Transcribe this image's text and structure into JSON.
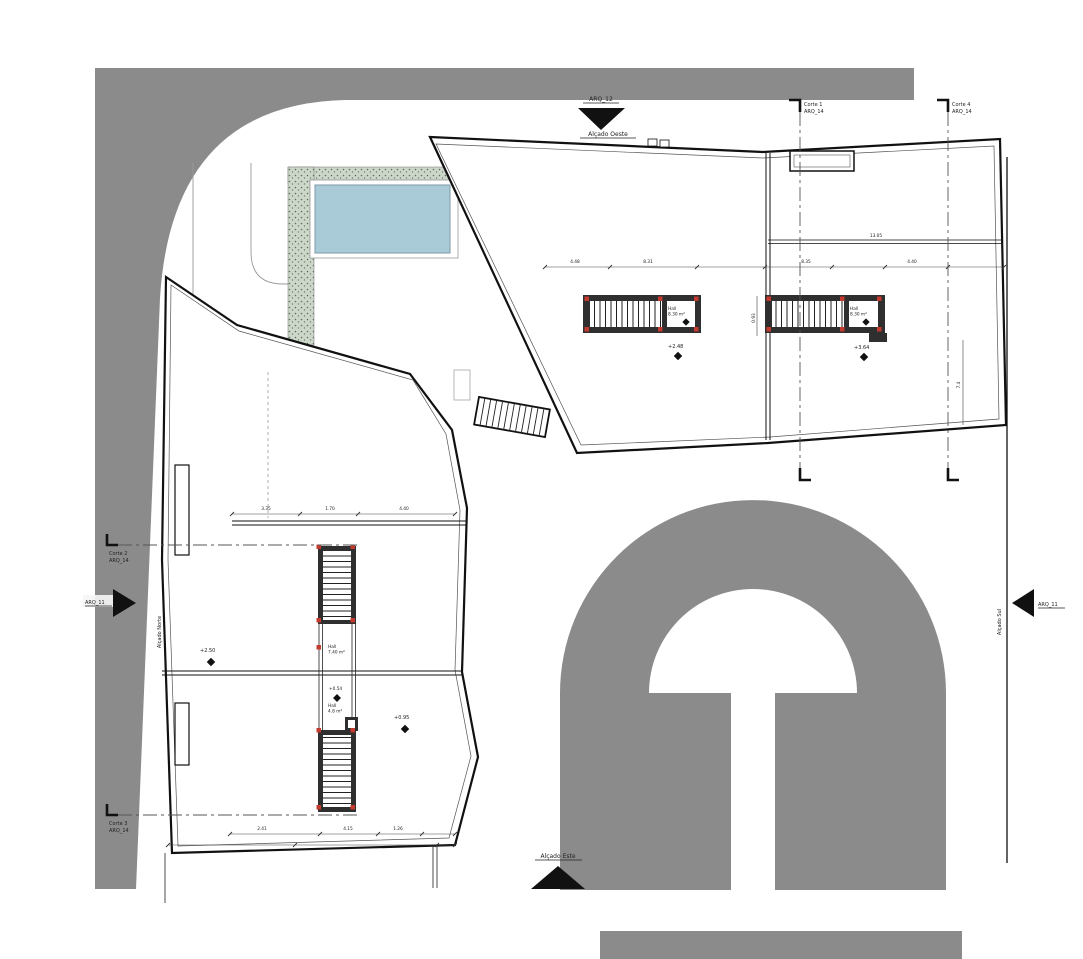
{
  "markers": {
    "west": {
      "sheet": "ARQ_12",
      "label": "Alçado Oeste"
    },
    "north": {
      "sheet": "ARQ_11",
      "label": "Alçado Norte"
    },
    "south": {
      "sheet": "ARQ_11",
      "label": "Alçado Sul"
    },
    "east": {
      "label": "Alçado Este"
    }
  },
  "sections": {
    "c1": {
      "name": "Corte 1",
      "sheet": "ARQ_14"
    },
    "c2": {
      "name": "Corte 2",
      "sheet": "ARQ_14"
    },
    "c3": {
      "name": "Corte 3",
      "sheet": "ARQ_14"
    },
    "c4": {
      "name": "Corte 4",
      "sheet": "ARQ_14"
    }
  },
  "rooms": {
    "hall1": {
      "name": "Hall",
      "area": "8.30 m²"
    },
    "hall2": {
      "name": "Hall",
      "area": "8.30 m²"
    },
    "hall3": {
      "name": "Hall",
      "area": "7.40 m²"
    },
    "hall4": {
      "name": "Hall",
      "area": "4.8 m²"
    }
  },
  "levels": {
    "stair1": "+2.48",
    "stair2": "+3.64",
    "terrace": "+2.50",
    "hall": "+0.54",
    "room": "+0.95"
  },
  "dimensions": {
    "upper": {
      "d1": "4.48",
      "d2": "8.31",
      "d3": "8.35",
      "d4": "4.40",
      "total": "13.05",
      "v1": "7.4",
      "v2": "0.93"
    },
    "lower": {
      "t1": "3.35",
      "t2": "1.70",
      "t3": "4.40",
      "b1": "2.41",
      "b2": "4.15",
      "b3": "1.26"
    }
  },
  "colors": {
    "road": "#8b8b8b",
    "pool_water": "#a9cbd8",
    "deck": "#ccd6c9",
    "accent_red": "#c23b2e"
  }
}
